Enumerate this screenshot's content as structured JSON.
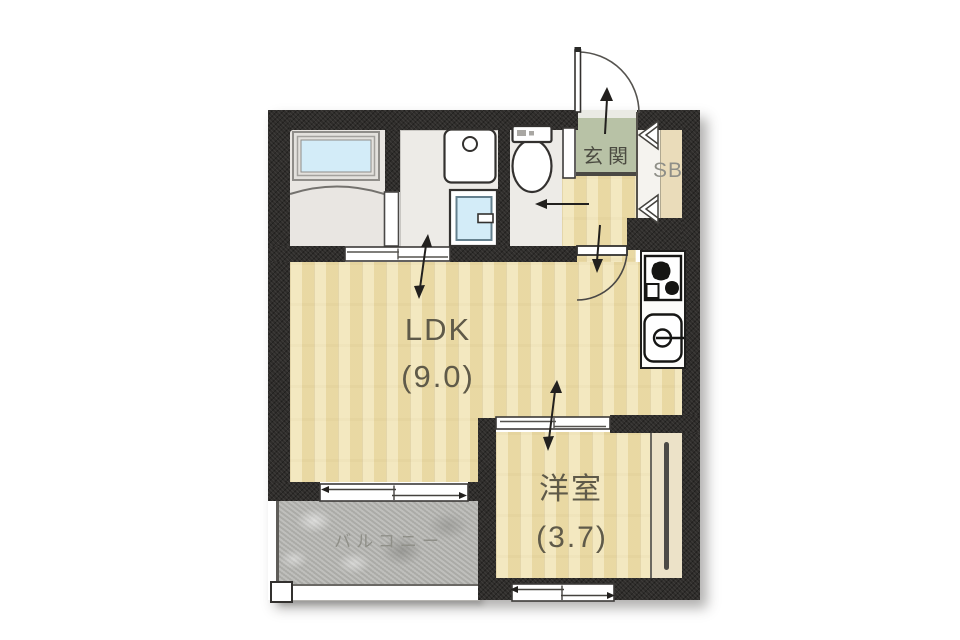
{
  "labels": {
    "genkan": "玄関",
    "shoe_box": "SB",
    "ldk_name": "LDK",
    "ldk_size": "(9.0)",
    "western_room_name": "洋室",
    "western_room_size": "(3.7)",
    "balcony": "バルコニー"
  },
  "colors": {
    "page_bg": "#ffffff",
    "wall": "#2f2d2b",
    "wood": "#f0e2ae",
    "genkan_floor": "#b8c2a6",
    "step_line": "#4a4843",
    "service_floor": "#edebe7",
    "balcony_floor": "#b6b6b2",
    "cabinet": "#eadcba",
    "closet": "#ece2c8",
    "water": "#d3ecf8",
    "fixture_outline": "#2a2a28",
    "label_dark": "#5f5a49",
    "label_entry": "#4b4b41",
    "label_muted": "#8f8f88"
  }
}
